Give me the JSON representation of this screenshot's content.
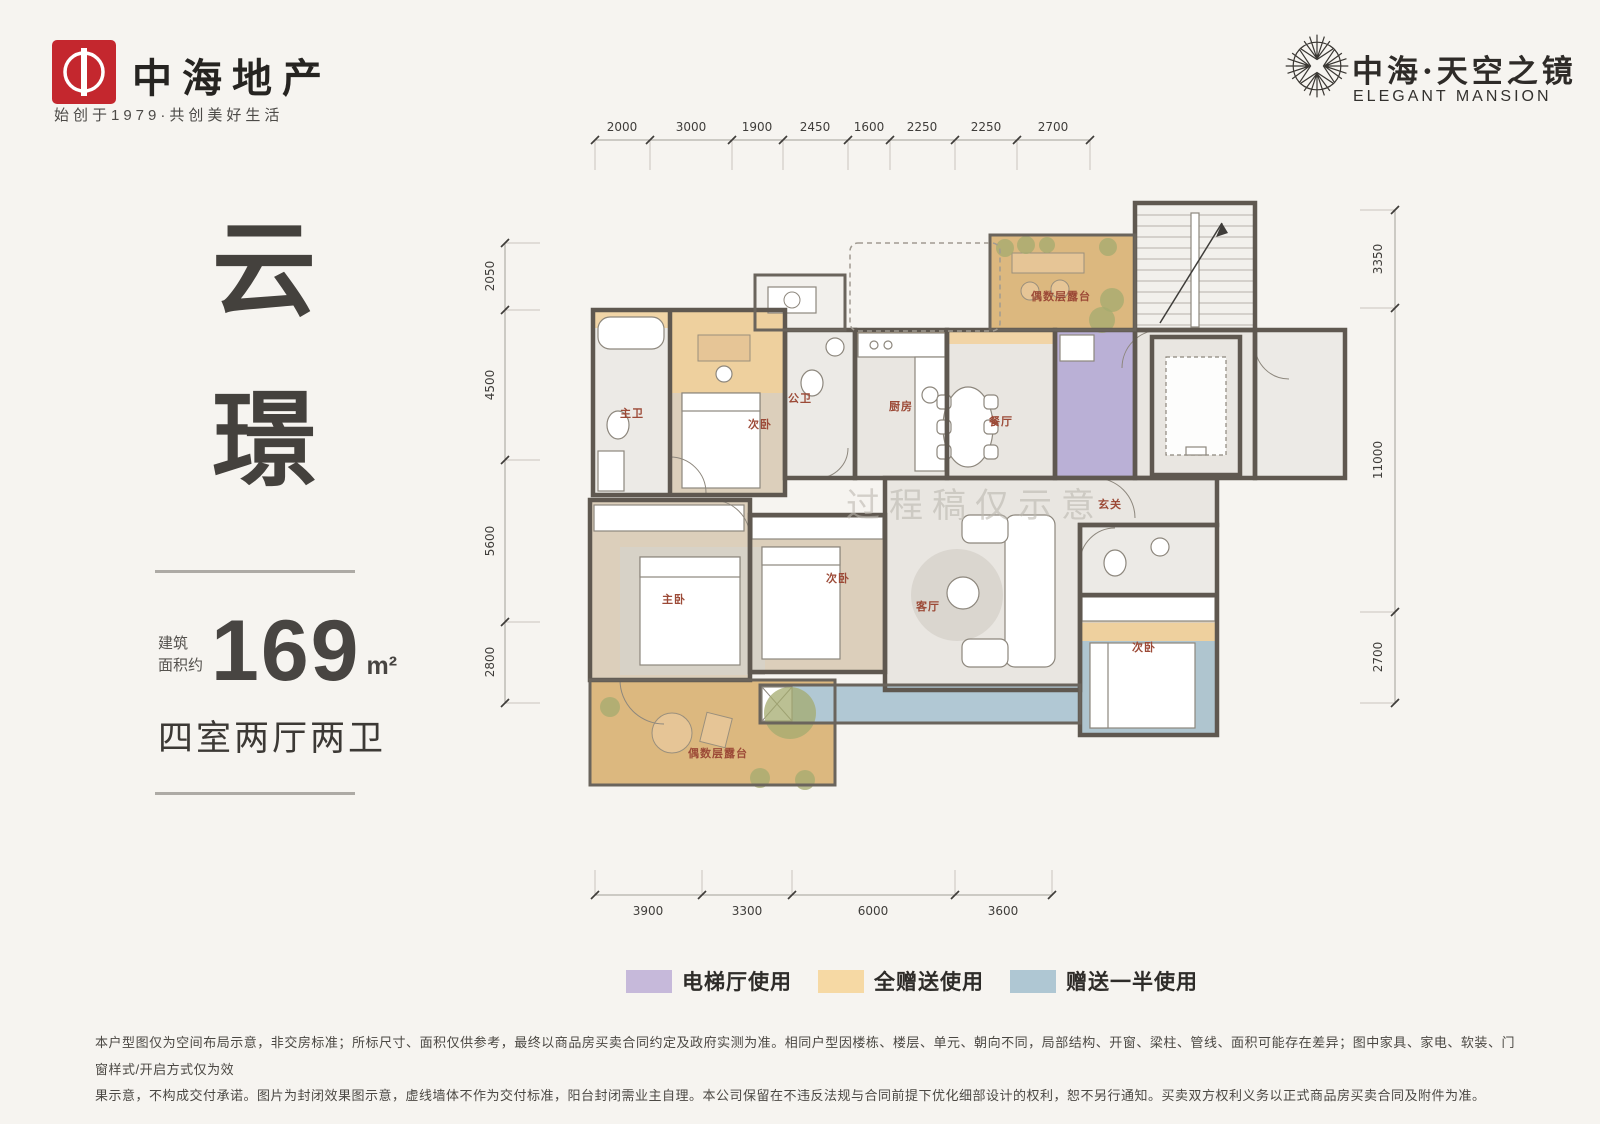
{
  "header": {
    "brand": {
      "logo_color": "#c4272e",
      "name": "中海地产",
      "tagline": "始创于1979·共创美好生活"
    },
    "project": {
      "name": "中海·天空之镜",
      "name_en": "ELEGANT MANSION"
    }
  },
  "info_panel": {
    "title_chars": [
      "云",
      "璟"
    ],
    "area_label_line1": "建筑",
    "area_label_line2": "面积约",
    "area_value": "169",
    "area_unit": "m²",
    "layout_text": "四室两厅两卫"
  },
  "plan": {
    "watermark": "过程稿仅示意",
    "rooms": [
      {
        "id": "master-bath",
        "label": "主卫"
      },
      {
        "id": "bedroom-top",
        "label": "次卧"
      },
      {
        "id": "guest-bath",
        "label": "公卫"
      },
      {
        "id": "kitchen",
        "label": "厨房"
      },
      {
        "id": "dining",
        "label": "餐厅"
      },
      {
        "id": "foyer",
        "label": "玄关"
      },
      {
        "id": "master-bedroom",
        "label": "主卧"
      },
      {
        "id": "bedroom-middle",
        "label": "次卧"
      },
      {
        "id": "living-room",
        "label": "客厅"
      },
      {
        "id": "bedroom-right",
        "label": "次卧"
      },
      {
        "id": "terrace-top",
        "label": "偶数层露台"
      },
      {
        "id": "terrace-bottom",
        "label": "偶数层露台"
      }
    ],
    "dimensions": {
      "top": [
        "2000",
        "3000",
        "1900",
        "2450",
        "1600",
        "2250",
        "2250",
        "2700"
      ],
      "bottom": [
        "3900",
        "3300",
        "6000",
        "3600"
      ],
      "left": [
        "2050",
        "4500",
        "5600",
        "2800"
      ],
      "right": [
        "3350",
        "11000",
        "2700"
      ]
    },
    "colors": {
      "wall": "#5f5850",
      "floor_gray": "#e9e6e1",
      "floor_wood": "#dccfbb",
      "terrace_orange": "#dcb87f",
      "gift_orange": "#f2cf97",
      "half_gift_blue": "#a9c4d2",
      "elevator_purple": "#bab0d6"
    }
  },
  "legend": {
    "items": [
      {
        "label": "电梯厅使用",
        "color": "#c6b9da"
      },
      {
        "label": "全赠送使用",
        "color": "#f6d9a4"
      },
      {
        "label": "赠送一半使用",
        "color": "#afc7d3"
      }
    ]
  },
  "disclaimer": {
    "line1": "本户型图仅为空间布局示意，非交房标准；所标尺寸、面积仅供参考，最终以商品房买卖合同约定及政府实测为准。相同户型因楼栋、楼层、单元、朝向不同，局部结构、开窗、梁柱、管线、面积可能存在差异；图中家具、家电、软装、门窗样式/开启方式仅为效",
    "line2": "果示意，不构成交付承诺。图片为封闭效果图示意，虚线墙体不作为交付标准，阳台封闭需业主自理。本公司保留在不违反法规与合同前提下优化细部设计的权利，恕不另行通知。买卖双方权利义务以正式商品房买卖合同及附件为准。"
  }
}
